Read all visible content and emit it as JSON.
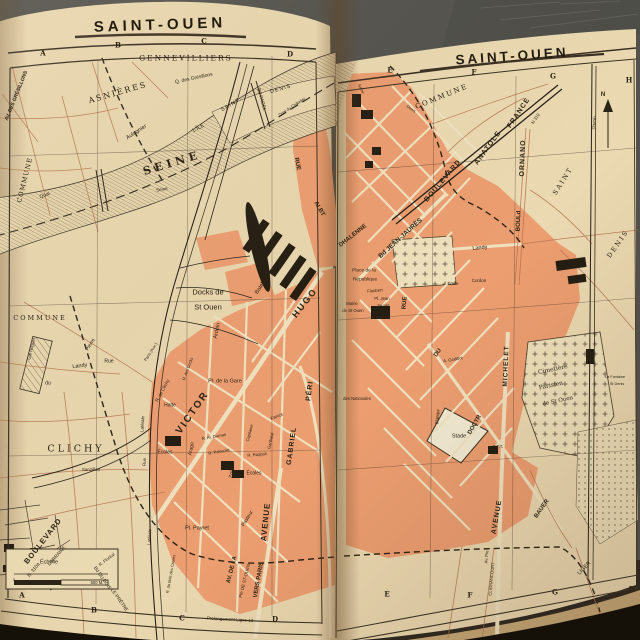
{
  "palette": {
    "page_cream": "#e9d7af",
    "built_area_orange": "#ec9e70",
    "map_ink": "#2b2217",
    "road_red": "#b5714c",
    "photo_background": "#53524d"
  },
  "left_page": {
    "title": "SAINT-OUEN"
  },
  "right_page": {
    "title": "SAINT-OUEN"
  },
  "labels": [
    {
      "t": "A",
      "x": 43,
      "y": 53,
      "s": 7,
      "w": 700,
      "f": 1
    },
    {
      "t": "B",
      "x": 118,
      "y": 45,
      "s": 7,
      "w": 700,
      "f": 1
    },
    {
      "t": "C",
      "x": 204,
      "y": 41,
      "s": 7,
      "w": 700,
      "f": 1
    },
    {
      "t": "D",
      "x": 290,
      "y": 54,
      "s": 7,
      "w": 700,
      "f": 1
    },
    {
      "t": "A",
      "x": 22,
      "y": 595,
      "s": 7,
      "w": 700,
      "f": 1
    },
    {
      "t": "B",
      "x": 94,
      "y": 610,
      "s": 7,
      "w": 700,
      "f": 1
    },
    {
      "t": "C",
      "x": 182,
      "y": 618,
      "s": 7,
      "w": 700,
      "f": 1
    },
    {
      "t": "D",
      "x": 275,
      "y": 619,
      "s": 7,
      "w": 700,
      "f": 1
    },
    {
      "t": "E",
      "x": 390,
      "y": 70,
      "s": 7,
      "w": 700,
      "f": 1
    },
    {
      "t": "F",
      "x": 474,
      "y": 72,
      "s": 7,
      "w": 700,
      "f": 1
    },
    {
      "t": "G",
      "x": 553,
      "y": 76,
      "s": 7,
      "w": 700,
      "f": 1
    },
    {
      "t": "H",
      "x": 629,
      "y": 80,
      "s": 7,
      "w": 700,
      "f": 1
    },
    {
      "t": "E",
      "x": 387,
      "y": 594,
      "s": 7,
      "w": 700,
      "f": 1
    },
    {
      "t": "F",
      "x": 470,
      "y": 595,
      "s": 7,
      "w": 700,
      "f": 1
    },
    {
      "t": "G",
      "x": 555,
      "y": 592,
      "s": 7,
      "w": 700,
      "f": 1
    },
    {
      "t": "H",
      "x": 632,
      "y": 589,
      "s": 7,
      "w": 700,
      "f": 1
    },
    {
      "t": "Prolongement Ligne 13",
      "x": 230,
      "y": 620,
      "s": 4.5,
      "r": 3
    },
    {
      "t": "GENNEVILLIERS",
      "x": 186,
      "y": 58,
      "s": 7.5,
      "ls": 2,
      "f": 1
    },
    {
      "t": "Q. des Grésillons",
      "x": 194,
      "y": 79,
      "s": 5,
      "r": -12
    },
    {
      "t": "AV. DES GRÉSILLONS",
      "x": 17,
      "y": 96,
      "s": 5,
      "r": -68,
      "w": 700
    },
    {
      "t": "ASNIÈRES",
      "x": 118,
      "y": 93,
      "s": 8,
      "r": -16,
      "ls": 2,
      "f": 1
    },
    {
      "t": "Aulagnier",
      "x": 137,
      "y": 133,
      "s": 5.5,
      "r": -33
    },
    {
      "t": "COMMUNE",
      "x": 25,
      "y": 180,
      "s": 6.5,
      "r": -76,
      "ls": 1,
      "f": 1
    },
    {
      "t": "SEINE",
      "x": 172,
      "y": 163,
      "s": 11,
      "r": -17,
      "ls": 4,
      "w": 700,
      "f": 1
    },
    {
      "t": "Quai",
      "x": 45,
      "y": 196,
      "s": 5,
      "r": -22
    },
    {
      "t": "L'ÎLE",
      "x": 199,
      "y": 129,
      "s": 5.5,
      "r": -28
    },
    {
      "t": "SAINT",
      "x": 231,
      "y": 106,
      "s": 5.5,
      "r": -30,
      "ls": 1
    },
    {
      "t": "DENIS",
      "x": 281,
      "y": 90,
      "s": 5.5,
      "r": -16,
      "ls": 1
    },
    {
      "t": "Bd PAGEL",
      "x": 260,
      "y": 100,
      "s": 4.8,
      "r": 75
    },
    {
      "t": "Quai du Châtelier",
      "x": 292,
      "y": 107,
      "s": 4,
      "r": -33
    },
    {
      "t": "Seine",
      "x": 162,
      "y": 190,
      "s": 4.5,
      "r": -10
    },
    {
      "t": "COMMUNE",
      "x": 40,
      "y": 318,
      "s": 6.5,
      "ls": 2,
      "f": 1
    },
    {
      "t": "Docks de",
      "x": 208,
      "y": 292,
      "s": 7.5
    },
    {
      "t": "St Ouen",
      "x": 208,
      "y": 307,
      "s": 7.5
    },
    {
      "t": "Bateliers",
      "x": 263,
      "y": 285,
      "s": 5.5,
      "r": -58
    },
    {
      "t": "Ardoin",
      "x": 218,
      "y": 331,
      "s": 5.5,
      "r": -78
    },
    {
      "t": "R. des Docks",
      "x": 188,
      "y": 369,
      "s": 4,
      "r": -70
    },
    {
      "t": "HUGO",
      "x": 305,
      "y": 303,
      "s": 9,
      "r": -52,
      "ls": 2,
      "w": 700
    },
    {
      "t": "VICTOR",
      "x": 193,
      "y": 413,
      "s": 10,
      "r": -55,
      "ls": 2,
      "w": 700
    },
    {
      "t": "Pl. de la Gare",
      "x": 225,
      "y": 382,
      "s": 5.5
    },
    {
      "t": "Halte",
      "x": 170,
      "y": 406,
      "s": 5
    },
    {
      "t": "Écoles",
      "x": 165,
      "y": 453,
      "s": 5
    },
    {
      "t": "Écoles",
      "x": 254,
      "y": 474,
      "s": 5
    },
    {
      "t": "Arago",
      "x": 192,
      "y": 449,
      "s": 5,
      "r": -80
    },
    {
      "t": "R. Al. Dumas",
      "x": 214,
      "y": 437,
      "s": 4.2,
      "r": -10
    },
    {
      "t": "R. Palouzie",
      "x": 219,
      "y": 452,
      "s": 4.2,
      "r": -10
    },
    {
      "t": "Zola",
      "x": 233,
      "y": 473,
      "s": 5.5,
      "r": -80
    },
    {
      "t": "R. Raspail",
      "x": 257,
      "y": 455,
      "s": 4.2,
      "r": -5
    },
    {
      "t": "Farcot",
      "x": 277,
      "y": 417,
      "s": 4.5,
      "r": -22
    },
    {
      "t": "Garibaldi",
      "x": 271,
      "y": 441,
      "s": 4.2,
      "r": -78
    },
    {
      "t": "Capitaine",
      "x": 250,
      "y": 433,
      "s": 4.2,
      "r": -75
    },
    {
      "t": "GABRIEL",
      "x": 292,
      "y": 446,
      "s": 7,
      "r": -82,
      "ls": 1,
      "w": 700
    },
    {
      "t": "PÉRI",
      "x": 310,
      "y": 391,
      "s": 7,
      "r": -82,
      "ls": 1,
      "w": 700
    },
    {
      "t": "CLICHY",
      "x": 76,
      "y": 449,
      "s": 9.5,
      "ls": 3,
      "f": 1
    },
    {
      "t": "du",
      "x": 48,
      "y": 384,
      "s": 5
    },
    {
      "t": "Landy",
      "x": 80,
      "y": 367,
      "s": 5.5,
      "r": -8
    },
    {
      "t": "Rue",
      "x": 109,
      "y": 362,
      "s": 5
    },
    {
      "t": "Pierre",
      "x": 91,
      "y": 345,
      "s": 5,
      "r": -58
    },
    {
      "t": "R. de Clichy",
      "x": 163,
      "y": 391,
      "s": 4.6,
      "r": -62
    },
    {
      "t": "Latérale",
      "x": 143,
      "y": 424,
      "s": 4.4,
      "r": -86
    },
    {
      "t": "Paris (Aux.)",
      "x": 151,
      "y": 352,
      "s": 4,
      "r": -58
    },
    {
      "t": "Gal Roguet",
      "x": 32,
      "y": 349,
      "s": 4.4,
      "r": -76
    },
    {
      "t": "Sanzillon",
      "x": 91,
      "y": 470,
      "s": 4.5
    },
    {
      "t": "BOULEVARD",
      "x": 43,
      "y": 541,
      "s": 7.5,
      "r": -52,
      "ls": 1,
      "w": 700
    },
    {
      "t": "LORRAINE",
      "x": 58,
      "y": 557,
      "s": 4.8,
      "r": -48
    },
    {
      "t": "N. 310a",
      "x": 35,
      "y": 571,
      "s": 4.8,
      "r": -52
    },
    {
      "t": "Bd DU BOIS",
      "x": 101,
      "y": 579,
      "s": 4.8,
      "r": 55
    },
    {
      "t": "LE PRÊTRE",
      "x": 118,
      "y": 601,
      "s": 4.8,
      "r": 55
    },
    {
      "t": "R. Floréal",
      "x": 107,
      "y": 560,
      "s": 4.3,
      "r": -38
    },
    {
      "t": "Rue",
      "x": 145,
      "y": 462,
      "s": 4.4,
      "r": -88
    },
    {
      "t": "Latérale",
      "x": 150,
      "y": 537,
      "s": 4.4,
      "r": -86
    },
    {
      "t": "R. du Bois des Caures",
      "x": 171,
      "y": 574,
      "s": 3.9,
      "r": -80
    },
    {
      "t": "Pl. Payret",
      "x": 197,
      "y": 529,
      "s": 5.5
    },
    {
      "t": "Pasteur",
      "x": 248,
      "y": 519,
      "s": 5,
      "r": -58
    },
    {
      "t": "AVENUE",
      "x": 266,
      "y": 522,
      "s": 8,
      "r": -84,
      "ls": 1,
      "w": 700
    },
    {
      "t": "AV. DE LA",
      "x": 233,
      "y": 570,
      "s": 5.8,
      "r": -76,
      "w": 700
    },
    {
      "t": "Pte DE ST-OUEN",
      "x": 245,
      "y": 581,
      "s": 4.4,
      "r": -76
    },
    {
      "t": "VERS PARIS",
      "x": 259,
      "y": 580,
      "s": 6,
      "r": -80,
      "w": 700
    },
    {
      "t": "Échelle",
      "x": 49,
      "y": 563,
      "s": 5.5
    },
    {
      "t": "0",
      "x": 14,
      "y": 581,
      "s": 3.8
    },
    {
      "t": "500 M.",
      "x": 97,
      "y": 583,
      "s": 4.2
    },
    {
      "t": "COMMUNE",
      "x": 442,
      "y": 97,
      "s": 7,
      "r": -22,
      "ls": 2,
      "f": 1
    },
    {
      "t": "Seine",
      "x": 361,
      "y": 89,
      "s": 4,
      "r": 65
    },
    {
      "t": "Denis",
      "x": 411,
      "y": 109,
      "s": 4,
      "r": 35
    },
    {
      "t": "BOULEVARD",
      "x": 443,
      "y": 181,
      "s": 7,
      "r": -50,
      "ls": 1,
      "w": 700
    },
    {
      "t": "ANATOLE",
      "x": 488,
      "y": 148,
      "s": 7,
      "r": -54,
      "ls": 1,
      "w": 700
    },
    {
      "t": "FRANCE",
      "x": 519,
      "y": 113,
      "s": 7,
      "r": -56,
      "ls": 1,
      "w": 700
    },
    {
      "t": "N 310",
      "x": 536,
      "y": 119,
      "s": 4.4,
      "r": -56
    },
    {
      "t": "ORNANO",
      "x": 523,
      "y": 158,
      "s": 7,
      "r": -88,
      "ls": 1,
      "w": 700
    },
    {
      "t": "BOULd",
      "x": 519,
      "y": 221,
      "s": 6,
      "r": -88,
      "w": 700
    },
    {
      "t": "SAINT",
      "x": 563,
      "y": 181,
      "s": 6.5,
      "r": -58,
      "ls": 2,
      "f": 1
    },
    {
      "t": "DENIS",
      "x": 618,
      "y": 244,
      "s": 6.5,
      "r": -55,
      "ls": 2,
      "f": 1
    },
    {
      "t": "Chemin",
      "x": 595,
      "y": 123,
      "s": 3.8,
      "r": -85
    },
    {
      "t": "N",
      "x": 603,
      "y": 95,
      "s": 6,
      "w": 700
    },
    {
      "t": "RUE",
      "x": 297,
      "y": 164,
      "s": 6,
      "r": 78,
      "w": 700
    },
    {
      "t": "ALBT",
      "x": 319,
      "y": 209,
      "s": 6,
      "r": 60,
      "w": 700
    },
    {
      "t": "DHALENNE",
      "x": 353,
      "y": 236,
      "s": 6,
      "r": -38,
      "w": 700
    },
    {
      "t": "Bd JEAN-JAURÈS",
      "x": 401,
      "y": 239,
      "s": 6.5,
      "r": -42,
      "w": 700
    },
    {
      "t": "Place de la",
      "x": 364,
      "y": 272,
      "s": 4.8
    },
    {
      "t": "République",
      "x": 365,
      "y": 281,
      "s": 4.8
    },
    {
      "t": "Flaubert",
      "x": 375,
      "y": 291,
      "s": 4.2,
      "r": -5
    },
    {
      "t": "Pl. Jean",
      "x": 382,
      "y": 299,
      "s": 4.2
    },
    {
      "t": "Jaurès",
      "x": 383,
      "y": 306,
      "s": 4.2
    },
    {
      "t": "Mairie",
      "x": 352,
      "y": 304,
      "s": 4.2
    },
    {
      "t": "de St Ouen",
      "x": 353,
      "y": 311,
      "s": 4.2
    },
    {
      "t": "RUE",
      "x": 405,
      "y": 303,
      "s": 6,
      "r": -85,
      "w": 700
    },
    {
      "t": "DU",
      "x": 438,
      "y": 353,
      "s": 6,
      "r": -55,
      "w": 700
    },
    {
      "t": "DOCTR",
      "x": 475,
      "y": 425,
      "s": 6,
      "r": -60,
      "w": 700
    },
    {
      "t": "BAUER",
      "x": 542,
      "y": 509,
      "s": 6,
      "r": -55,
      "w": 700
    },
    {
      "t": "Landy",
      "x": 480,
      "y": 249,
      "s": 5.5,
      "r": -6
    },
    {
      "t": "Émile",
      "x": 453,
      "y": 284,
      "s": 4.4
    },
    {
      "t": "Cordon",
      "x": 479,
      "y": 281,
      "s": 4.4
    },
    {
      "t": "MICHELET",
      "x": 507,
      "y": 366,
      "s": 6.5,
      "r": -88,
      "ls": 1,
      "w": 700
    },
    {
      "t": "A. Godillot",
      "x": 453,
      "y": 360,
      "s": 4.3,
      "r": -10
    },
    {
      "t": "Blanqui",
      "x": 438,
      "y": 417,
      "s": 4.5,
      "r": -85
    },
    {
      "t": "Stade",
      "x": 459,
      "y": 437,
      "s": 5.5
    },
    {
      "t": "des Nationales",
      "x": 357,
      "y": 399,
      "s": 4.2
    },
    {
      "t": "Cimetière",
      "x": 553,
      "y": 370,
      "s": 6,
      "r": -12,
      "f": 1
    },
    {
      "t": "Parisien",
      "x": 551,
      "y": 386,
      "s": 6,
      "r": -12,
      "f": 1
    },
    {
      "t": "de St Ouen",
      "x": 558,
      "y": 402,
      "s": 5.5,
      "r": -12,
      "f": 1
    },
    {
      "t": "P.T.T.",
      "x": 498,
      "y": 447,
      "s": 4.4
    },
    {
      "t": "AVENUE",
      "x": 497,
      "y": 517,
      "s": 7,
      "r": -80,
      "ls": 1,
      "w": 700
    },
    {
      "t": "Av. Pte",
      "x": 487,
      "y": 557,
      "s": 4.2,
      "r": -85
    },
    {
      "t": "CLIGNANCOURT",
      "x": 492,
      "y": 579,
      "s": 4.2,
      "r": -85
    },
    {
      "t": "LIGER",
      "x": 585,
      "y": 569,
      "s": 5.5,
      "r": -45
    },
    {
      "t": "La Fontaine",
      "x": 615,
      "y": 378,
      "s": 3.8
    },
    {
      "t": "St Denis",
      "x": 617,
      "y": 385,
      "s": 3.8
    }
  ]
}
